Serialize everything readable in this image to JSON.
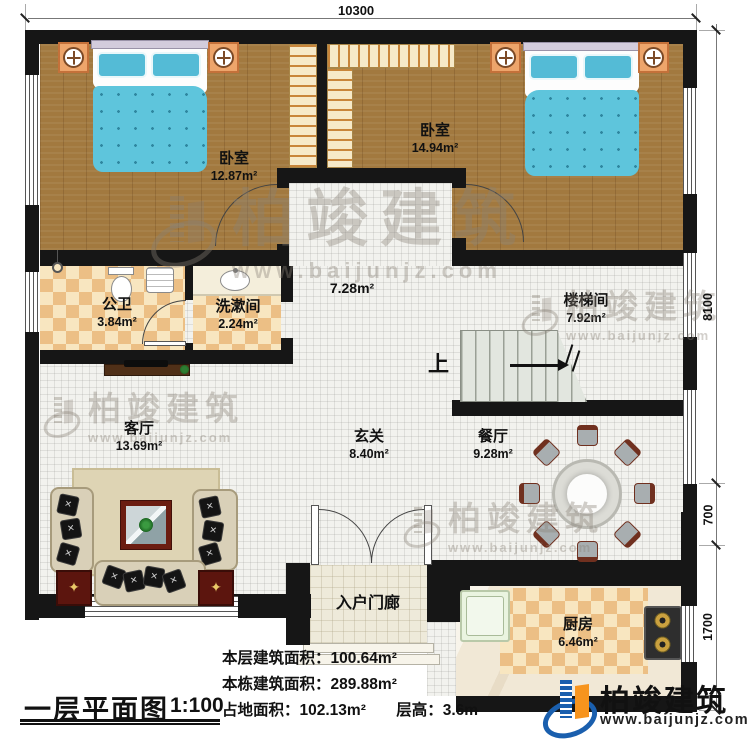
{
  "plan": {
    "title": "一层平面图",
    "scale": "1:100",
    "dims": {
      "top": "10300",
      "right_upper": "8100",
      "right_mid": "700",
      "right_lower": "1700"
    }
  },
  "rooms": {
    "bedroom1": {
      "name": "卧室",
      "area": "12.87m²"
    },
    "bedroom2": {
      "name": "卧室",
      "area": "14.94m²"
    },
    "bathroom": {
      "name": "公卫",
      "area": "3.84m²"
    },
    "washroom": {
      "name": "洗漱间",
      "area": "2.24m²"
    },
    "hall": {
      "area": "7.28m²"
    },
    "stairwell": {
      "name": "楼梯间",
      "area": "7.92m²",
      "up": "上"
    },
    "living": {
      "name": "客厅",
      "area": "13.69m²"
    },
    "foyer": {
      "name": "玄关",
      "area": "8.40m²"
    },
    "dining": {
      "name": "餐厅",
      "area": "9.28m²"
    },
    "porch": {
      "name": "入户门廊"
    },
    "kitchen": {
      "name": "厨房",
      "area": "6.46m²"
    }
  },
  "stats": {
    "l1": {
      "label": "本层建筑面积：",
      "value": "100.64m²"
    },
    "l2": {
      "label": "本栋建筑面积：",
      "value": "289.88m²"
    },
    "l3": {
      "label": "占地面积：",
      "value": "102.13m²"
    },
    "l3b": {
      "label": "层高：",
      "value": "3.6m"
    }
  },
  "branding": {
    "company": "柏竣建筑",
    "website": "www.baijunjz.com"
  },
  "colors": {
    "wall": "#161616",
    "wood": "#a2793f",
    "bed_blue": "#5ec5dc",
    "tile_orange": "#ecbf85",
    "brand_blue": "#1a5fae",
    "brand_orange": "#f7941d"
  }
}
